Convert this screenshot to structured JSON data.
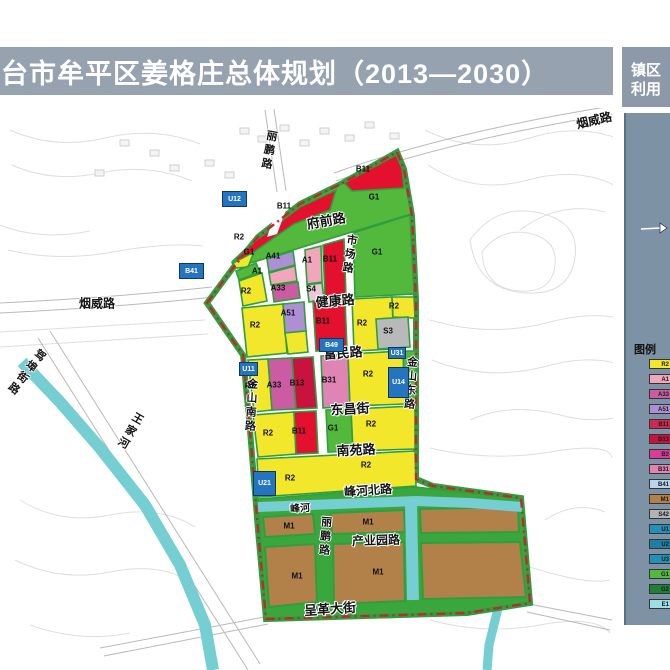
{
  "header": {
    "title": "台市牟平区姜格庄总体规划（2013—2030）"
  },
  "side_tab": {
    "lines": [
      "镇区",
      "利用"
    ]
  },
  "legend": {
    "title": "图例",
    "north_arrow": "north-arrow",
    "items": [
      {
        "code": "R2",
        "color": "#f3e72c"
      },
      {
        "code": "A1",
        "color": "#f2a6bb"
      },
      {
        "code": "A33",
        "color": "#cb5ba2"
      },
      {
        "code": "A51",
        "color": "#ad90d4"
      },
      {
        "code": "B11",
        "color": "#d02850"
      },
      {
        "code": "B13",
        "color": "#c9133f"
      },
      {
        "code": "B2",
        "color": "#d83e96"
      },
      {
        "code": "B31",
        "color": "#df84b4"
      },
      {
        "code": "B41",
        "color": "#b8d4ec"
      },
      {
        "code": "M1",
        "color": "#b28049"
      },
      {
        "code": "S42",
        "color": "#b3b3b3"
      },
      {
        "code": "U1",
        "color": "#2590b6"
      },
      {
        "code": "U2",
        "color": "#1f7ea6"
      },
      {
        "code": "U3",
        "color": "#2590b6"
      },
      {
        "code": "G1",
        "color": "#53b93d"
      },
      {
        "code": "G2",
        "color": "#1f8038"
      },
      {
        "code": "E1",
        "color": "#a0dce4"
      }
    ]
  },
  "palette": {
    "header_bg": "#96a2b0",
    "tab_bg": "#8d99a8",
    "panel_bg": "#7d92a5",
    "boundary_red": "#c1272d",
    "river_teal": "#74ced2",
    "green_belt": "#2f9e3f",
    "marker_blue": "#2574c0"
  },
  "map": {
    "road_labels": [
      {
        "text": "烟威路",
        "x": 97,
        "y": 303,
        "rotate": 0,
        "size": 12
      },
      {
        "text": "烟威路",
        "x": 594,
        "y": 120,
        "rotate": -13,
        "size": 12
      },
      {
        "text": "府前路",
        "x": 326,
        "y": 220,
        "rotate": -10,
        "size": 13
      },
      {
        "text": "健康路",
        "x": 335,
        "y": 300,
        "rotate": -5,
        "size": 13
      },
      {
        "text": "富民路",
        "x": 343,
        "y": 352,
        "rotate": -4,
        "size": 13
      },
      {
        "text": "东昌街",
        "x": 350,
        "y": 408,
        "rotate": -3,
        "size": 13
      },
      {
        "text": "南苑路",
        "x": 356,
        "y": 449,
        "rotate": -3,
        "size": 13
      },
      {
        "text": "峰河北路",
        "x": 368,
        "y": 490,
        "rotate": -4,
        "size": 12
      },
      {
        "text": "产业园路",
        "x": 376,
        "y": 540,
        "rotate": -2,
        "size": 12
      },
      {
        "text": "呈革大街",
        "x": 330,
        "y": 608,
        "rotate": -4,
        "size": 13
      },
      {
        "text": "峰河",
        "x": 300,
        "y": 507,
        "rotate": -3,
        "size": 10
      }
    ],
    "vertical_labels": [
      {
        "text": "丽鹏路",
        "x": 272,
        "y": 130,
        "rotate": 10
      },
      {
        "text": "市场路",
        "x": 352,
        "y": 234,
        "rotate": 8
      },
      {
        "text": "金山南路",
        "x": 252,
        "y": 378,
        "rotate": 3
      },
      {
        "text": "金山东路",
        "x": 412,
        "y": 356,
        "rotate": 4
      },
      {
        "text": "丽鹏路",
        "x": 326,
        "y": 516,
        "rotate": 4
      },
      {
        "text": "驾埠街路",
        "x": 43,
        "y": 350,
        "rotate": 38
      },
      {
        "text": "王家河",
        "x": 140,
        "y": 413,
        "rotate": 30
      }
    ],
    "zone_labels": [
      {
        "code": "B11",
        "x": 284,
        "y": 206
      },
      {
        "code": "B11",
        "x": 363,
        "y": 169
      },
      {
        "code": "G1",
        "x": 374,
        "y": 197
      },
      {
        "code": "R2",
        "x": 239,
        "y": 237
      },
      {
        "code": "G1",
        "x": 249,
        "y": 252
      },
      {
        "code": "A41",
        "x": 273,
        "y": 256
      },
      {
        "code": "A1",
        "x": 257,
        "y": 271
      },
      {
        "code": "A33",
        "x": 278,
        "y": 288
      },
      {
        "code": "R2",
        "x": 246,
        "y": 291
      },
      {
        "code": "A1",
        "x": 307,
        "y": 260
      },
      {
        "code": "S4",
        "x": 311,
        "y": 289
      },
      {
        "code": "B11",
        "x": 330,
        "y": 259
      },
      {
        "code": "G1",
        "x": 377,
        "y": 252
      },
      {
        "code": "R2",
        "x": 255,
        "y": 325
      },
      {
        "code": "A51",
        "x": 288,
        "y": 313
      },
      {
        "code": "B11",
        "x": 323,
        "y": 321
      },
      {
        "code": "R2",
        "x": 362,
        "y": 323
      },
      {
        "code": "R2",
        "x": 394,
        "y": 306
      },
      {
        "code": "S3",
        "x": 388,
        "y": 331
      },
      {
        "code": "R2",
        "x": 250,
        "y": 386
      },
      {
        "code": "A33",
        "x": 274,
        "y": 385
      },
      {
        "code": "B13",
        "x": 297,
        "y": 383
      },
      {
        "code": "B31",
        "x": 329,
        "y": 380
      },
      {
        "code": "R2",
        "x": 368,
        "y": 374
      },
      {
        "code": "R2",
        "x": 268,
        "y": 433
      },
      {
        "code": "B11",
        "x": 299,
        "y": 431
      },
      {
        "code": "G1",
        "x": 333,
        "y": 428
      },
      {
        "code": "R2",
        "x": 371,
        "y": 424
      },
      {
        "code": "R2",
        "x": 290,
        "y": 478
      },
      {
        "code": "R2",
        "x": 366,
        "y": 465
      },
      {
        "code": "M1",
        "x": 289,
        "y": 526
      },
      {
        "code": "M1",
        "x": 368,
        "y": 522
      },
      {
        "code": "M1",
        "x": 297,
        "y": 576
      },
      {
        "code": "M1",
        "x": 378,
        "y": 572
      }
    ],
    "markers": [
      {
        "code": "U12",
        "x": 222,
        "y": 191,
        "w": 25,
        "h": 16
      },
      {
        "code": "B41",
        "x": 179,
        "y": 263,
        "w": 25,
        "h": 16
      },
      {
        "code": "B49",
        "x": 319,
        "y": 338,
        "w": 25,
        "h": 14
      },
      {
        "code": "U11",
        "x": 239,
        "y": 362,
        "w": 19,
        "h": 14
      },
      {
        "code": "U31",
        "x": 388,
        "y": 347,
        "w": 18,
        "h": 12
      },
      {
        "code": "U14",
        "x": 388,
        "y": 367,
        "w": 21,
        "h": 31
      },
      {
        "code": "U21",
        "x": 253,
        "y": 471,
        "w": 23,
        "h": 25
      }
    ]
  }
}
